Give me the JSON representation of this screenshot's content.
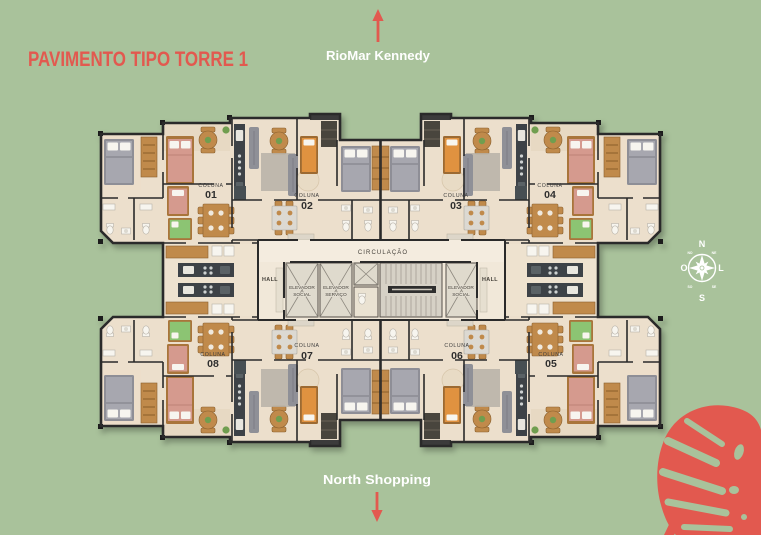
{
  "title": "PAVIMENTO TIPO TORRE 1",
  "directions": {
    "top": "RioMar Kennedy",
    "bottom": "North Shopping"
  },
  "compass": {
    "n": "N",
    "s": "S",
    "e": "L",
    "w": "O",
    "ne": "NE",
    "nw": "NO",
    "se": "SE",
    "sw": "SO"
  },
  "plan": {
    "circulation": "CIRCULAÇÃO",
    "hall_left": "HALL",
    "hall_right": "HALL",
    "elevator_social_left": {
      "line1": "ELEVADOR",
      "line2": "SOCIAL"
    },
    "elevator_service": {
      "line1": "ELEVADOR",
      "line2": "SERVIÇO"
    },
    "elevator_social_right": {
      "line1": "ELEVADOR",
      "line2": "SOCIAL"
    },
    "columns": [
      {
        "label": "COLUNA",
        "number": "01"
      },
      {
        "label": "COLUNA",
        "number": "02"
      },
      {
        "label": "COLUNA",
        "number": "03"
      },
      {
        "label": "COLUNA",
        "number": "04"
      },
      {
        "label": "COLUNA",
        "number": "05"
      },
      {
        "label": "COLUNA",
        "number": "06"
      },
      {
        "label": "COLUNA",
        "number": "07"
      },
      {
        "label": "COLUNA",
        "number": "08"
      }
    ]
  },
  "colors": {
    "background": "#a9c29b",
    "accent": "#e2594f",
    "label-light": "#ffffff",
    "label-dark": "#3b3b3b",
    "floor": "#ecdfcc",
    "floor-core": "#f1e8d9",
    "wall": "#2b2b2b",
    "wood": "#c08a4c",
    "wood-dark": "#8a5f2c",
    "bed-pink": "#d59a8e",
    "bed-green": "#8cc473",
    "bed-gray": "#a7a7af",
    "counter-dark": "#3c4347",
    "fixture-white": "#f7f5ef"
  }
}
